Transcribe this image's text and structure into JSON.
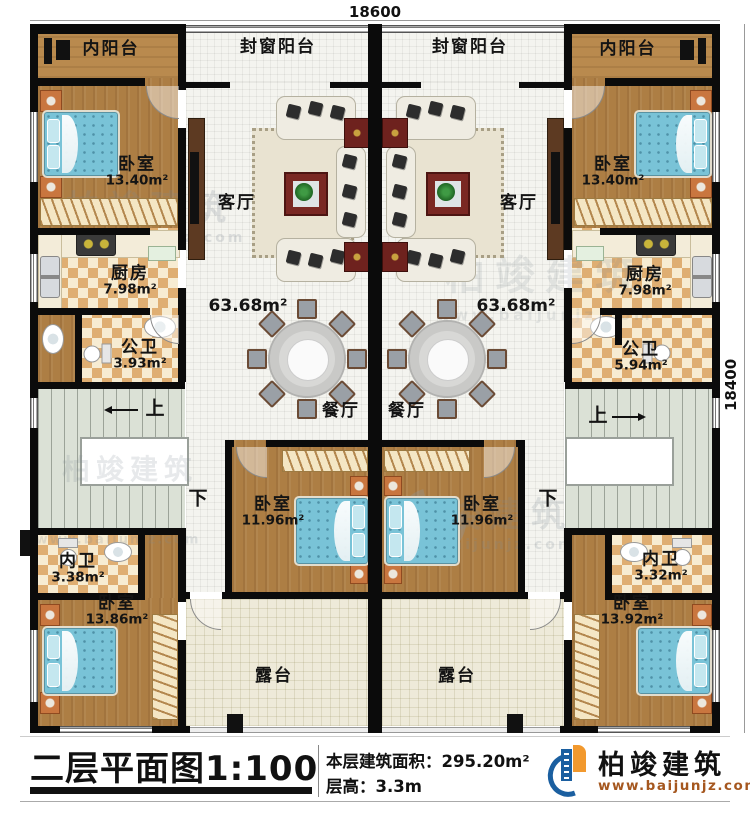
{
  "dimensions": {
    "width_label": "18600",
    "height_label": "18400"
  },
  "rooms": {
    "inner_balcony_left": {
      "name": "内阳台"
    },
    "inner_balcony_right": {
      "name": "内阳台"
    },
    "sealed_balcony_left": {
      "name": "封窗阳台"
    },
    "sealed_balcony_right": {
      "name": "封窗阳台"
    },
    "living_left": {
      "name": "客厅"
    },
    "living_right": {
      "name": "客厅"
    },
    "living_area_left": {
      "area": "63.68m²"
    },
    "living_area_right": {
      "area": "63.68m²"
    },
    "dining_left": {
      "name": "餐厅"
    },
    "dining_right": {
      "name": "餐厅"
    },
    "kitchen_left": {
      "name": "厨房",
      "area": "7.98m²"
    },
    "kitchen_right": {
      "name": "厨房",
      "area": "7.98m²"
    },
    "public_bath_left": {
      "name": "公卫",
      "area": "3.93m²"
    },
    "public_bath_right": {
      "name": "公卫",
      "area": "5.94m²"
    },
    "bedroom_top_left": {
      "name": "卧室",
      "area": "13.40m²"
    },
    "bedroom_top_right": {
      "name": "卧室",
      "area": "13.40m²"
    },
    "bedroom_mid_left": {
      "name": "卧室",
      "area": "11.96m²"
    },
    "bedroom_mid_right": {
      "name": "卧室",
      "area": "11.96m²"
    },
    "ensuite_bath_left": {
      "name": "内卫",
      "area": "3.38m²"
    },
    "ensuite_bath_right": {
      "name": "内卫",
      "area": "3.32m²"
    },
    "bedroom_bottom_left": {
      "name": "卧室",
      "area": "13.86m²"
    },
    "bedroom_bottom_right": {
      "name": "卧室",
      "area": "13.92m²"
    },
    "terrace_left": {
      "name": "露台"
    },
    "terrace_right": {
      "name": "露台"
    }
  },
  "stairs": {
    "up": "上",
    "down": "下"
  },
  "watermark": {
    "brand": "柏竣建筑",
    "site": "www.baijunjz.com"
  },
  "footer": {
    "title": "二层平面图1:100",
    "area_text": "本层建筑面积：295.20m²",
    "floor_height_text": "层高：3.3m",
    "brand": "柏竣建筑",
    "site": "www.baijunjz.com"
  },
  "colors": {
    "wall": "#0b0b0b",
    "bed": "#79c3d7",
    "logo_blue": "#1b5fa0",
    "logo_orange": "#f2992e",
    "site_text": "#a5571f"
  }
}
